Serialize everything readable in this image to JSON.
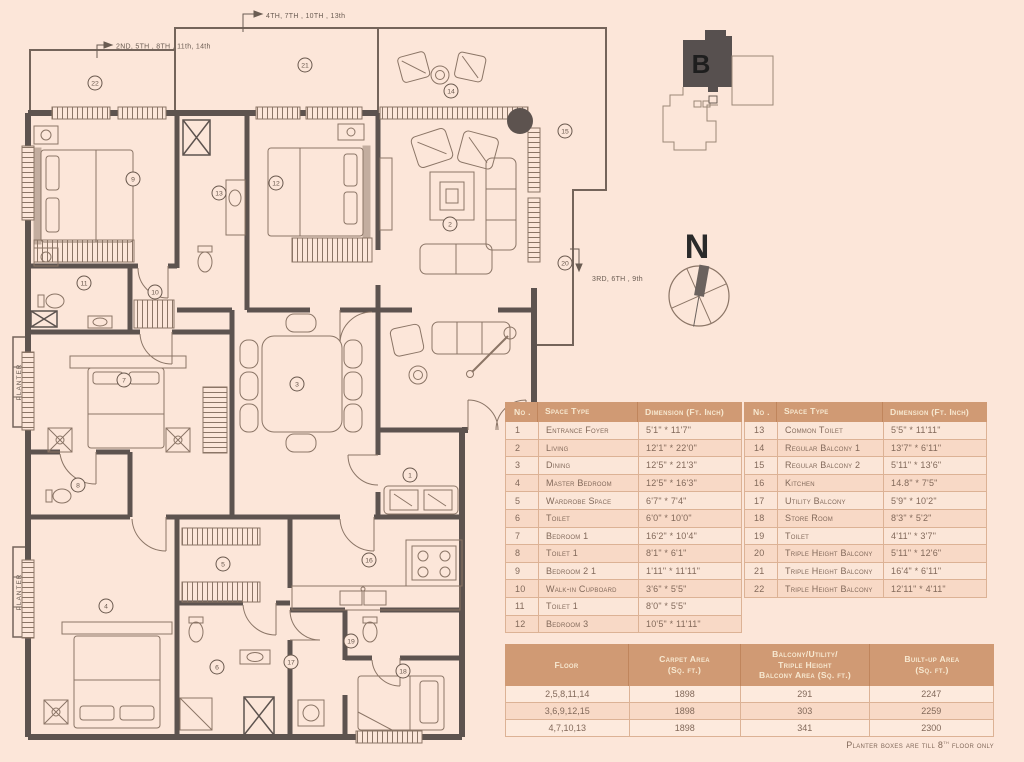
{
  "plan": {
    "floor_labels": {
      "top": "4TH, 7TH , 10TH , 13th",
      "left": "2ND, 5TH , 8TH , 11th, 14th",
      "right": "3RD, 6TH , 9th"
    },
    "planter_label": "PLANTER",
    "compass_letter": "N",
    "key_plan_letter": "B",
    "markers": [
      {
        "n": "22",
        "x": 95,
        "y": 83
      },
      {
        "n": "21",
        "x": 305,
        "y": 65
      },
      {
        "n": "14",
        "x": 451,
        "y": 91
      },
      {
        "n": "15",
        "x": 565,
        "y": 131
      },
      {
        "n": "20",
        "x": 565,
        "y": 263
      },
      {
        "n": "9",
        "x": 133,
        "y": 179
      },
      {
        "n": "13",
        "x": 219,
        "y": 193
      },
      {
        "n": "12",
        "x": 276,
        "y": 183
      },
      {
        "n": "11",
        "x": 84,
        "y": 283
      },
      {
        "n": "10",
        "x": 155,
        "y": 292
      },
      {
        "n": "2",
        "x": 450,
        "y": 224
      },
      {
        "n": "7",
        "x": 124,
        "y": 380
      },
      {
        "n": "3",
        "x": 297,
        "y": 384
      },
      {
        "n": "8",
        "x": 78,
        "y": 485
      },
      {
        "n": "1",
        "x": 410,
        "y": 475
      },
      {
        "n": "4",
        "x": 106,
        "y": 606
      },
      {
        "n": "5",
        "x": 223,
        "y": 564
      },
      {
        "n": "6",
        "x": 217,
        "y": 667
      },
      {
        "n": "16",
        "x": 369,
        "y": 560
      },
      {
        "n": "17",
        "x": 291,
        "y": 662
      },
      {
        "n": "19",
        "x": 351,
        "y": 641
      },
      {
        "n": "18",
        "x": 403,
        "y": 671
      }
    ]
  },
  "tables": {
    "space_table_headers": {
      "no": "No .",
      "type": "Space Type",
      "dim": "Dimension (Ft. Inch)"
    },
    "spaces_left": [
      {
        "no": "1",
        "type": "Entrance Foyer",
        "dim": "5'1\" * 11'7\""
      },
      {
        "no": "2",
        "type": "Living",
        "dim": "12'1\" * 22'0\""
      },
      {
        "no": "3",
        "type": "Dining",
        "dim": "12'5\" * 21'3\""
      },
      {
        "no": "4",
        "type": "Master Bedroom",
        "dim": "12'5\" * 16'3\""
      },
      {
        "no": "5",
        "type": "Wardrobe Space",
        "dim": "6'7\" * 7'4\""
      },
      {
        "no": "6",
        "type": "Toilet",
        "dim": "6'0\" * 10'0\""
      },
      {
        "no": "7",
        "type": "Bedroom 1",
        "dim": "16'2\" * 10'4\""
      },
      {
        "no": "8",
        "type": "Toilet 1",
        "dim": "8'1\" * 6'1\""
      },
      {
        "no": "9",
        "type": "Bedroom 2 1",
        "dim": "1'11\" * 11'11\""
      },
      {
        "no": "10",
        "type": "Walk-in Cupboard",
        "dim": "3'6\" * 5'5\""
      },
      {
        "no": "11",
        "type": "Toilet 1",
        "dim": "8'0\" * 5'5\""
      },
      {
        "no": "12",
        "type": "Bedroom 3",
        "dim": "10'5\" * 11'11\""
      }
    ],
    "spaces_right": [
      {
        "no": "13",
        "type": "Common Toilet",
        "dim": "5'5\" * 11'11\""
      },
      {
        "no": "14",
        "type": "Regular Balcony 1",
        "dim": "13'7\" * 6'11\""
      },
      {
        "no": "15",
        "type": "Regular Balcony 2",
        "dim": "5'11\" * 13'6\""
      },
      {
        "no": "16",
        "type": "Kitchen",
        "dim": "14.8\" * 7'5\""
      },
      {
        "no": "17",
        "type": "Utility Balcony",
        "dim": "5'9\" * 10'2\""
      },
      {
        "no": "18",
        "type": "Store Room",
        "dim": "8'3\" * 5'2\""
      },
      {
        "no": "19",
        "type": "Toilet",
        "dim": "4'11\" * 3'7\""
      },
      {
        "no": "20",
        "type": "Triple Height Balcony",
        "dim": "5'11\" * 12'6\""
      },
      {
        "no": "21",
        "type": "Triple Height Balcony",
        "dim": "16'4\" * 6'11\""
      },
      {
        "no": "22",
        "type": "Triple Height Balcony",
        "dim": "12'11\" * 4'11\""
      }
    ],
    "area_table": {
      "header_lines": [
        [
          "Floor"
        ],
        [
          "Carpet Area",
          "(Sq. ft.)"
        ],
        [
          "Balcony/Utility/",
          "Triple Height",
          "Balcony Area (Sq. ft.)"
        ],
        [
          "Built-up Area",
          "(Sq. ft.)"
        ]
      ],
      "rows": [
        [
          "2,5,8,11,14",
          "1898",
          "291",
          "2247"
        ],
        [
          "3,6,9,12,15",
          "1898",
          "303",
          "2259"
        ],
        [
          "4,7,10,13",
          "1898",
          "341",
          "2300"
        ]
      ]
    }
  },
  "footer": {
    "prefix": "Planter boxes are till 8",
    "sup": "th",
    "suffix": " floor only"
  },
  "colors": {
    "background": "#fce6d9",
    "wall": "#5d534f",
    "furniture_line": "#8b7566",
    "table_header_bg": "#d09a74",
    "table_header_text": "#f7e8d0",
    "table_text": "#82695a",
    "row_light": "#fbe6d8",
    "row_dark": "#f8d9c6",
    "keyplan_dark": "#57504f"
  }
}
